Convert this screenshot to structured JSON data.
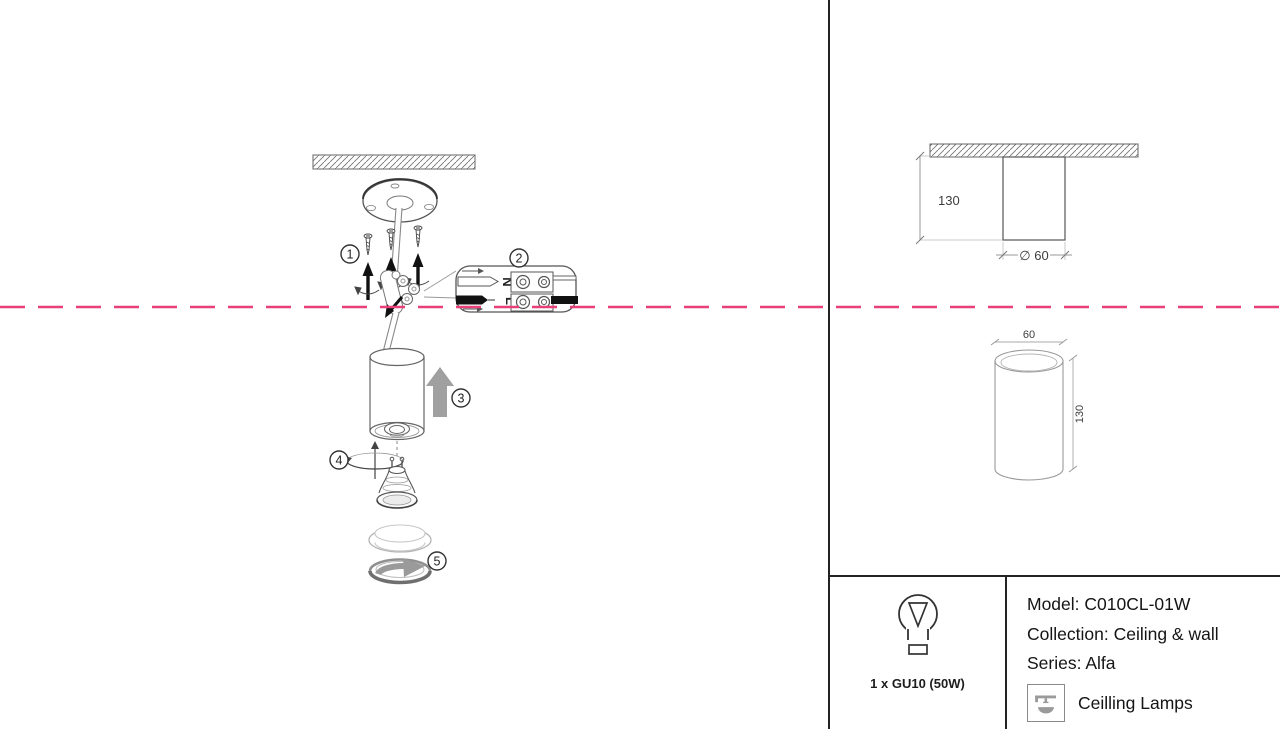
{
  "colors": {
    "fold_line": "#e8417a",
    "divider": "#232323",
    "line_art": "#555555",
    "icon_gray": "#9a9a9a"
  },
  "steps": {
    "s1": "1",
    "s2": "2",
    "s3": "3",
    "s4": "4",
    "s5": "5"
  },
  "connector_labels": {
    "neutral": "N",
    "live": "L"
  },
  "dimensions": {
    "side_view": {
      "height": "130",
      "diameter": "∅ 60"
    },
    "iso_view": {
      "diameter": "60",
      "height": "130"
    }
  },
  "spec_panel": {
    "lamp_count": "1 x GU10 (50W)",
    "model": "Model: C010CL-01W",
    "collection": "Collection: Ceiling & wall",
    "series": "Series: Alfa",
    "category": "Ceilling Lamps"
  }
}
